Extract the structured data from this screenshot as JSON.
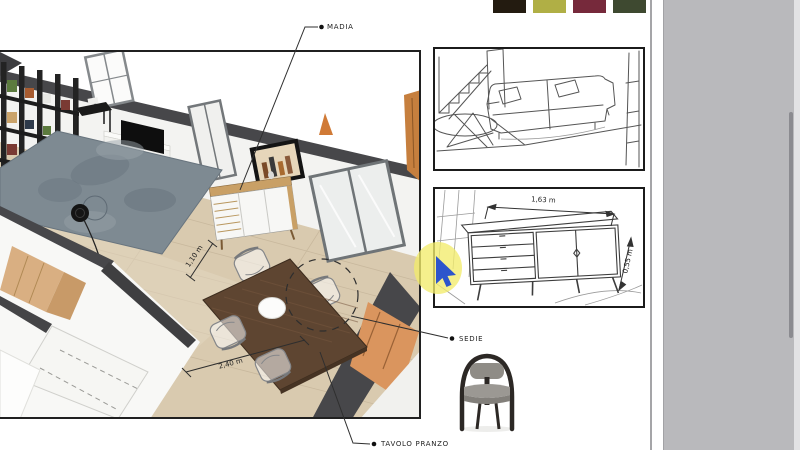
{
  "app": {
    "background": "#ffffff",
    "canvas_background": "#b9b9bc"
  },
  "palette": {
    "swatches": [
      {
        "name": "dark-espresso",
        "color": "#231b10"
      },
      {
        "name": "olive-green",
        "color": "#b0af45"
      },
      {
        "name": "burgundy",
        "color": "#76293b"
      },
      {
        "name": "forest-green",
        "color": "#3e4930"
      }
    ]
  },
  "annotations": {
    "madia": "MADIA",
    "sedie": "SEDIE",
    "tavolo_pranzo": "TAVOLO PRANZO"
  },
  "dimensions": {
    "table_length": "2,40 m",
    "table_depth": "1,10 m",
    "sideboard_width": "1,63 m",
    "sideboard_depth": "0,55 m"
  },
  "scene": {
    "floor_color": "#d9caaf",
    "wall_color": "#f3f3f1",
    "wall_cut_color": "#47474a",
    "rug_color": "#7e8a92",
    "table_wood_color": "#5e4531",
    "madia_wood_color": "#c9a066",
    "accent_orange": "#da955e"
  },
  "cursor": {
    "highlight_color": "#f2ec6b",
    "pointer_color": "#2d55cc"
  },
  "scrollbar": {
    "thumb_color": "#8b8b90"
  }
}
